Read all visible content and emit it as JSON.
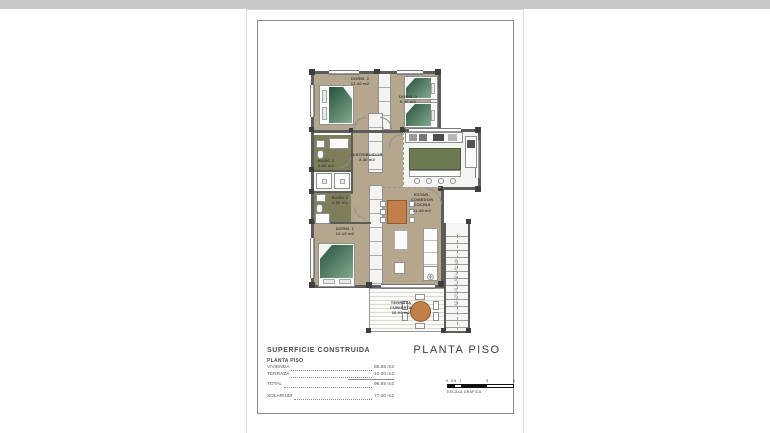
{
  "sheet": {
    "title": "PLANTA PISO",
    "surface": {
      "heading": "SUPERFICIE CONSTRUIDA",
      "subheading": "PLANTA PISO",
      "rows": [
        {
          "label": "VIVIENDA",
          "value": "86.85 m2"
        },
        {
          "label": "TERRAZA",
          "value": "10.00 m2"
        },
        {
          "label": "TOTAL",
          "value": "96.85 m2"
        },
        {
          "label": "SOLARIUM",
          "value": "77.00 m2"
        }
      ]
    },
    "scale_bar": {
      "labels": [
        "0",
        "0.5",
        "1",
        "3",
        "5"
      ],
      "caption": "ESCALA GRAFICA"
    }
  },
  "plan": {
    "rooms": [
      {
        "name": "DORM. 2",
        "area": "13.40 m2"
      },
      {
        "name": "DORM. 3",
        "area": "9.00 m2"
      },
      {
        "name": "BAÑO 2",
        "area": "3.80 m2"
      },
      {
        "name": "DISTRIBUIDOR",
        "area": "3.40 m2"
      },
      {
        "name": "BAÑO 1",
        "area": "3.50 m2"
      },
      {
        "name": "DORM. 1",
        "area": "12.10 m2"
      },
      {
        "name": "ESTAR-COMEDOR",
        "name2": "COCINA",
        "area": "21.40 m2"
      },
      {
        "name": "TERRAZA",
        "name2": "CUBIERTA",
        "area": "10.00 m2"
      }
    ],
    "stairs_label": "ACCESO A SOLARIUM",
    "icons": {
      "stairs_up_arrow": "↑",
      "side_table": "⊕"
    }
  },
  "colors": {
    "floor_brown": "#b5a78d",
    "bath_olive": "#7e7e5a",
    "bed_green": "#3c6a50",
    "table_orange": "#c08048",
    "wall_gray": "#5c5c5c",
    "kitchen_island": "#6d7950"
  }
}
